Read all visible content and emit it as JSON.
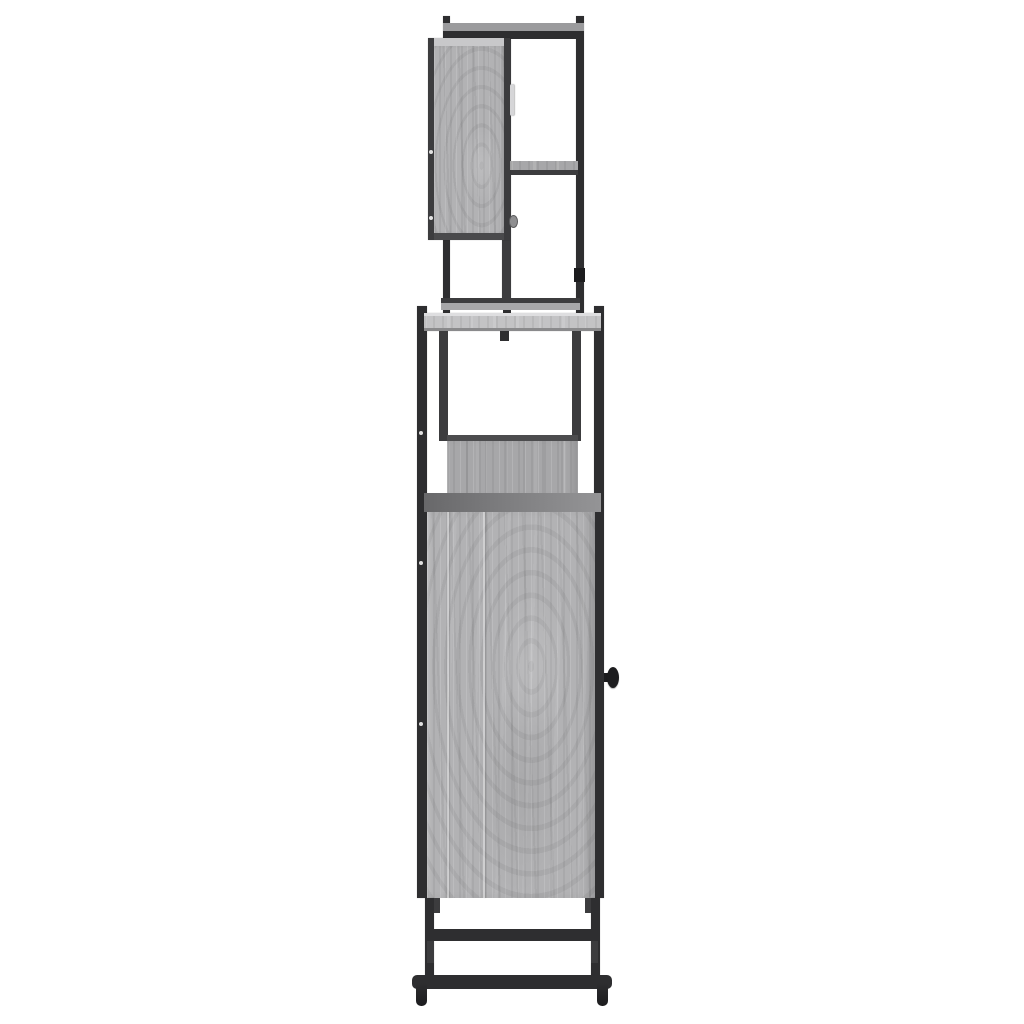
{
  "scene": {
    "type": "product-photo",
    "subject": "bathroom-furniture-set-side-view",
    "pieces": [
      {
        "name": "mirror-cabinet",
        "description": "wall cabinet with grey sonoma door in black steel frame, one open side shelf, bottom rail and feet",
        "features": [
          "top-rail",
          "door-panel",
          "door-handle-bar",
          "door-knob",
          "side-shelf",
          "bottom-rail",
          "frame-posts"
        ]
      },
      {
        "name": "base-cabinet",
        "description": "tall floor cabinet: wood top board, open shelf compartment, large door with round knob, black steel legs with double cross stretchers and feet",
        "features": [
          "top-board",
          "inner-posts",
          "shelf-box",
          "cabinet-top-edge",
          "cabinet-door",
          "round-knob",
          "legs",
          "upper-stretcher",
          "lower-stretcher",
          "feet"
        ]
      }
    ],
    "materials": {
      "panels": "grey sonoma engineered wood",
      "frame": "black powder-coated steel"
    },
    "background": "plain white studio background",
    "text_content": "none"
  },
  "colors": {
    "background": "#ffffff",
    "metal": "#2e2e30",
    "metal_mid": "#3c3c3e",
    "metal_dark": "#1c1c1e",
    "wood_base": "#b2b2b4",
    "wood_shelf": "#a7a7a9",
    "top_panel": "#c3c3c5",
    "panel_highlight": "#dedee0",
    "panel_underedge": "#8a8a8c",
    "cab_strip_left": "#68686a",
    "cab_strip_right": "#949496",
    "door_top_strip": "#c8c8ca",
    "door_bottom_strip": "#4a4a4c",
    "handle_light": "#d6d6d8",
    "small_knob": "#8e8e90",
    "rail_grey": "#9b9b9d"
  }
}
